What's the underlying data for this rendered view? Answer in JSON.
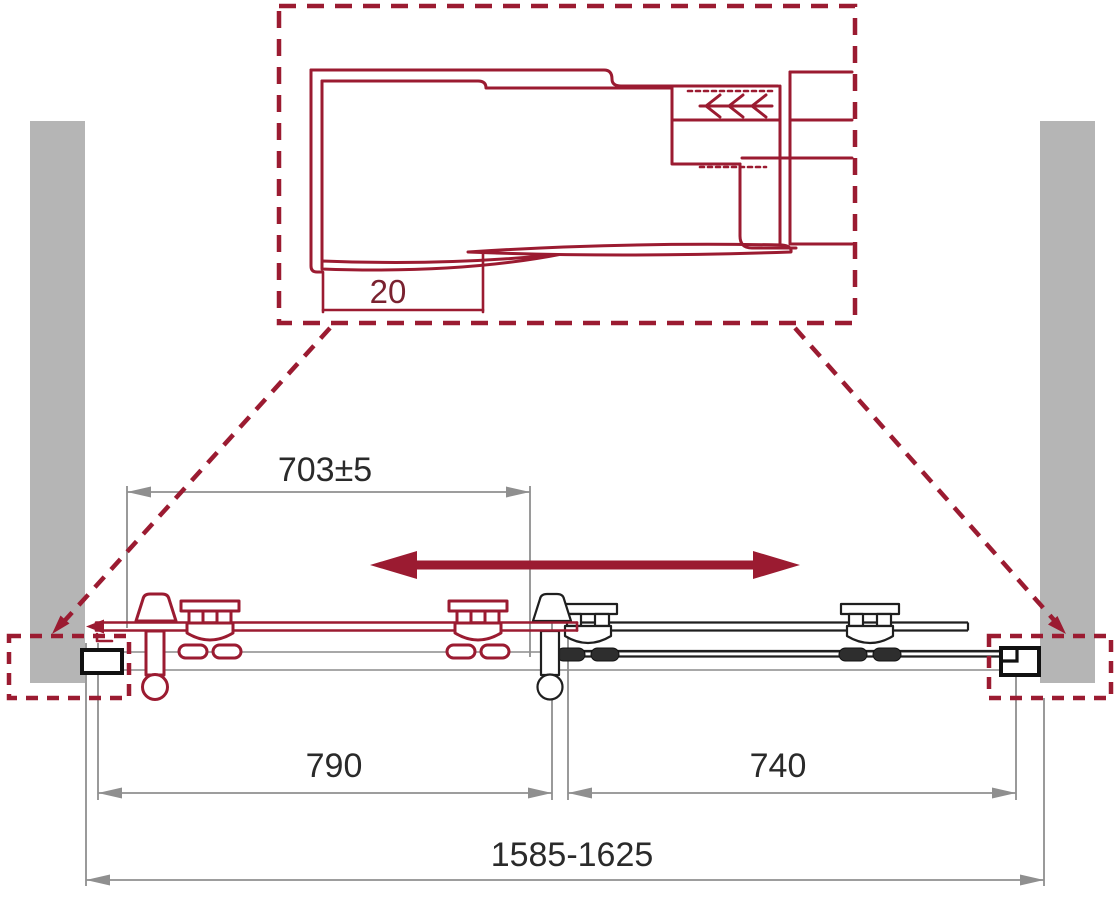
{
  "drawing": {
    "detail_view": {
      "gap_label": "20"
    },
    "dims": {
      "opening": "703±5",
      "door": "790",
      "panel": "740",
      "overall": "1585-1625"
    }
  },
  "colors": {
    "accent_maroon": "#9b1b31",
    "wall_gray": "#b5b5b5",
    "dimension_gray": "#8f8f8f",
    "drawing_black": "#1f1f1f",
    "text_dark": "#2a2a2a"
  }
}
